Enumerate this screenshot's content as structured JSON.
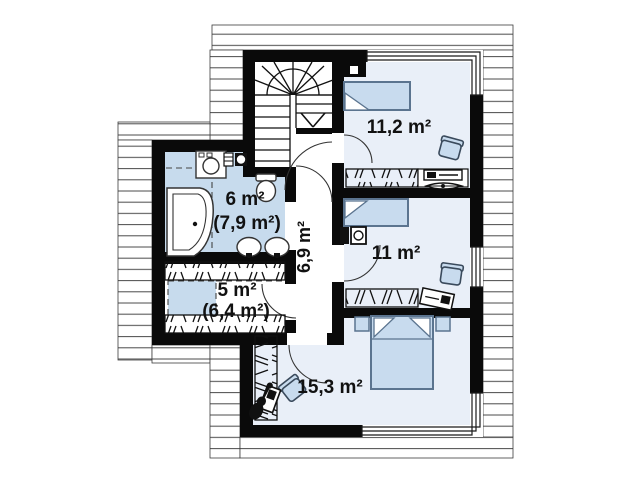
{
  "plan": {
    "type": "attic-floor-plan",
    "rooms": [
      {
        "name": "bathroom",
        "label": "6 m²",
        "sub_label": "(7,9 m²)"
      },
      {
        "name": "wardrobe",
        "label": "5 m²",
        "sub_label": "(6,4 m²)"
      },
      {
        "name": "hallway",
        "label": "6,9 m²"
      },
      {
        "name": "bedroom-top",
        "label": "11,2 m²"
      },
      {
        "name": "bedroom-middle",
        "label": "11 m²"
      },
      {
        "name": "bedroom-bottom",
        "label": "15,3 m²"
      }
    ],
    "colors": {
      "wall": "#0a0a0a",
      "bathroom_floor": "#c7dbed",
      "bedroom_floor": "#e9eff8",
      "furniture_fill": "#c8dbee",
      "roof_line": "#4a4a4a"
    }
  }
}
